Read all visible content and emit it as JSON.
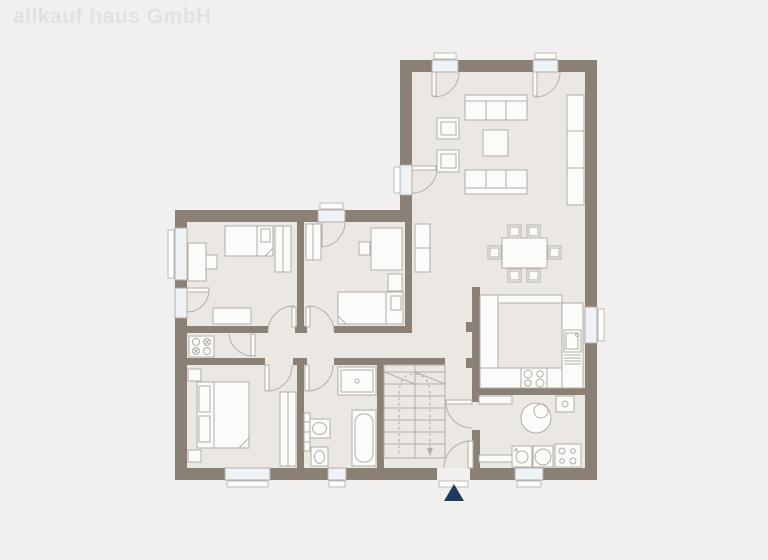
{
  "watermark": {
    "text": "allkauf haus GmbH"
  },
  "colors": {
    "background": "#f2f0ee",
    "floor": "#ebe8e4",
    "wall": "#8a8076",
    "line": "#b3ada6",
    "furniture_fill": "#fbfbfa",
    "window_glass": "#eef3f7",
    "entrance_marker": "#1f3a5f",
    "watermark": "#e3e0dd"
  },
  "plan": {
    "type": "floor-plan",
    "shape": "L-shaped ground floor",
    "entrance_marker": "navy triangle pointing up at front door",
    "rooms": [
      {
        "name": "living-dining-room",
        "furniture": [
          "three-seat-sofa",
          "three-seat-sofa",
          "armchair",
          "armchair",
          "coffee-table",
          "wall-shelf",
          "dining-table",
          "six-dining-chairs",
          "tall-cabinet"
        ]
      },
      {
        "name": "kitchen",
        "furniture": [
          "u-shaped-counter",
          "cooktop",
          "sink-with-drainer"
        ],
        "openings": [
          "window-right-wall"
        ]
      },
      {
        "name": "utility-room",
        "furniture": [
          "boiler",
          "washing-machine",
          "dryer",
          "laundry-appliance",
          "shelf",
          "bench"
        ],
        "openings": [
          "window-bottom-wall"
        ]
      },
      {
        "name": "hallway",
        "furniture": [
          "winder-staircase"
        ],
        "openings": [
          "entrance-door-bottom-wall"
        ]
      },
      {
        "name": "bathroom",
        "furniture": [
          "shower",
          "bathtub",
          "washbasin",
          "toilet",
          "radiator"
        ],
        "openings": [
          "window-bottom-wall"
        ]
      },
      {
        "name": "bedroom-1",
        "furniture": [
          "single-bed",
          "desk",
          "chair",
          "wardrobe",
          "dresser"
        ],
        "openings": [
          "window-left-wall",
          "side-door-left-wall"
        ]
      },
      {
        "name": "bedroom-2",
        "furniture": [
          "single-bed",
          "desk",
          "chair",
          "wardrobe",
          "small-cabinet"
        ],
        "openings": [
          "terrace-door-top-wall"
        ]
      },
      {
        "name": "master-bedroom",
        "furniture": [
          "double-bed",
          "nightstand",
          "nightstand",
          "wardrobe"
        ],
        "openings": [
          "window-bottom-wall"
        ]
      },
      {
        "name": "storage-niche",
        "furniture": [
          "cooktop-unit"
        ]
      }
    ],
    "exterior_openings": [
      "french-door-living-1",
      "french-door-living-2",
      "garden-door-living-west",
      "terrace-door-bedroom-2",
      "side-door-bedroom-1",
      "entrance-door"
    ]
  }
}
